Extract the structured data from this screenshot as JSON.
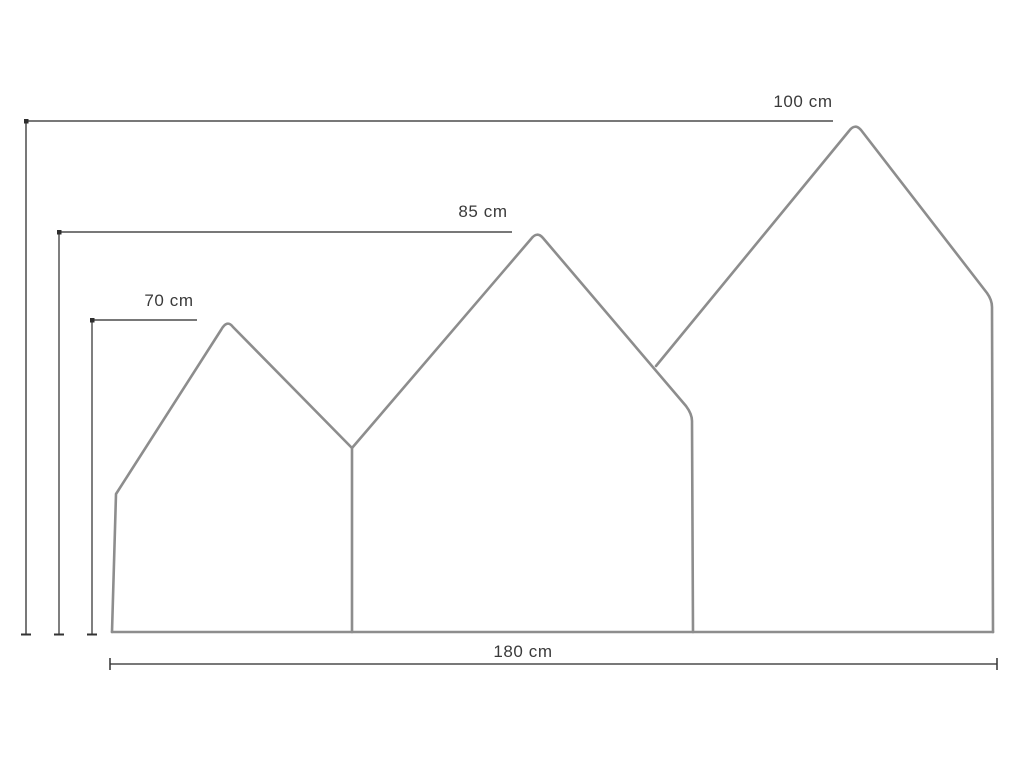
{
  "diagram": {
    "type": "dimension-diagram",
    "labels": {
      "small_house_height": "70 cm",
      "medium_house_height": "85 cm",
      "large_house_height": "100 cm",
      "total_width": "180 cm"
    },
    "measurements": {
      "unit": "cm",
      "small_house_height": 70,
      "medium_house_height": 85,
      "large_house_height": 100,
      "total_width": 180
    },
    "colors": {
      "outline": "#8d8d8d",
      "dimension_line": "#4c4c4c",
      "label_text": "#3a3a3a",
      "background": "#ffffff"
    }
  }
}
